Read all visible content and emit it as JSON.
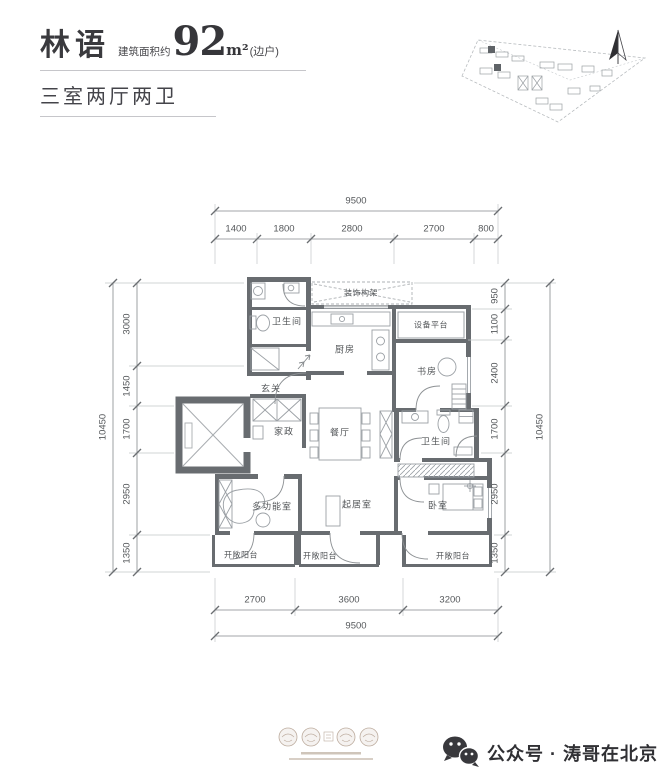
{
  "header": {
    "brand": "林语",
    "area_prefix": "建筑面积约",
    "area_value": "92",
    "area_unit": "m²",
    "area_note": "(边户)",
    "layout_title": "三室两厅两卫"
  },
  "dims": {
    "top": {
      "total": "9500",
      "segments": [
        "1400",
        "1800",
        "2800",
        "2700",
        "800"
      ]
    },
    "bottom": {
      "total": "9500",
      "segments": [
        "2700",
        "3600",
        "3200"
      ]
    },
    "left": {
      "total": "10450",
      "segments": [
        "3000",
        "1450",
        "1700",
        "2950",
        "1350"
      ]
    },
    "right": {
      "total": "10450",
      "segments": [
        "950",
        "1100",
        "2400",
        "1700",
        "2950",
        "1350"
      ]
    }
  },
  "rooms": {
    "bath_top": "卫生间",
    "deco_frame": "装饰构架",
    "equipment_platform": "设备平台",
    "kitchen": "厨房",
    "study": "书房",
    "entry": "玄关",
    "housekeeping": "家政",
    "dining": "餐厅",
    "bath_right": "卫生间",
    "multi_function": "多功能室",
    "living": "起居室",
    "bedroom": "卧室",
    "balcony_left": "开敞阳台",
    "balcony_mid": "开敞阳台",
    "balcony_right": "开敞阳台"
  },
  "footer": {
    "wechat_label": "公众号 · 涛哥在北京"
  },
  "colors": {
    "wall": "#686c70",
    "thin_line": "#9ba0a5",
    "dim_line": "#85898c",
    "accent_dark": "#333333"
  }
}
